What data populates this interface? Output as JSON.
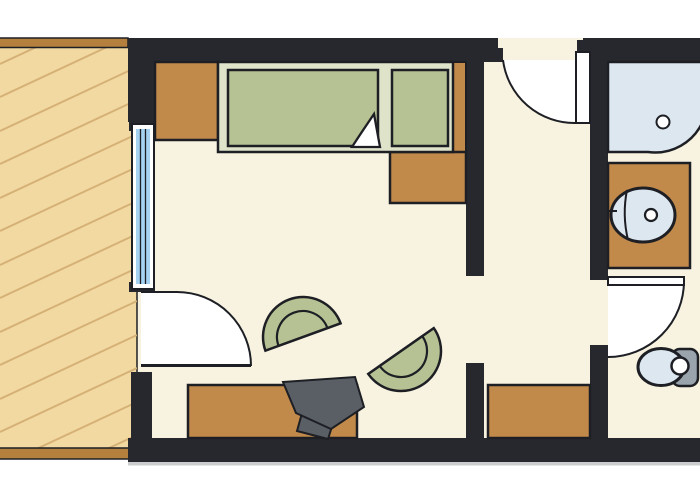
{
  "plan": {
    "name": "apartment-floor-plan",
    "elements": [
      "balcony-deck",
      "balcony-railing-top",
      "balcony-railing-bottom",
      "window",
      "balcony-door",
      "entrance-door",
      "bathroom-door",
      "nightstand",
      "bed-platform",
      "mattress",
      "pillow-section",
      "side-panel",
      "foot-dresser",
      "armchair-left",
      "armchair-right",
      "desk",
      "desk-chair",
      "hall-cabinet",
      "shower",
      "shower-drain",
      "vanity-counter",
      "washbasin",
      "basin-drain",
      "toilet-bowl",
      "toilet-tank",
      "toilet-flush"
    ]
  },
  "colors": {
    "background": "#ffffff",
    "floor": "#f8f3e0",
    "wall": "#26282e",
    "outline": "#1d1f24",
    "shadow": "#a0a2a5",
    "balcony_floor": "#f2d9a2",
    "balcony_hatch": "#d5b176",
    "railing": "#b5803e",
    "wood": "#c18a4a",
    "bed_base": "#dfe3ca",
    "upholstery": "#b7c294",
    "window_glass": "#a6d2f2",
    "fixture": "#dde7f0",
    "tank": "#9aa4ad",
    "desk_chair": "#5a5f66",
    "door_swing": "#ffffff",
    "white": "#ffffff"
  }
}
